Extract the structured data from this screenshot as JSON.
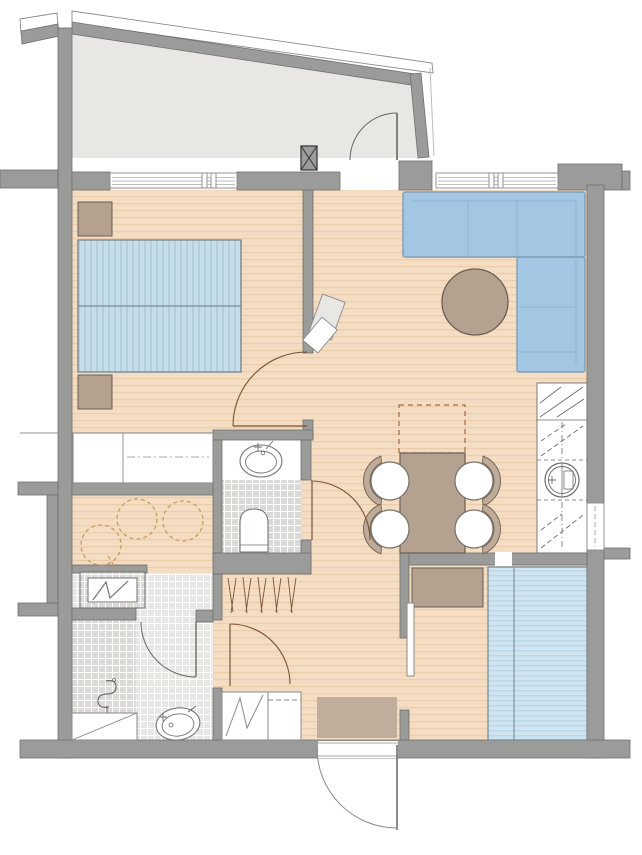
{
  "meta": {
    "kind": "architectural-floor-plan",
    "width_px": 642,
    "height_px": 855,
    "visible_text": []
  },
  "colors": {
    "wall": "#9b9b99",
    "wallEdge": "#6f6f6d",
    "dark": "#3a3a38",
    "floor": "#f4ddc2",
    "floorLine": "#eaceab",
    "terraceFloor": "#e9e7e4",
    "white": "#ffffff",
    "frameGray": "#8a8a88",
    "windowLine": "#a9a9a7",
    "bedFill": "#c7dee9",
    "bedStripe": "#b2cfe0",
    "beddingEdge": "#7b8a94",
    "sofaFill": "#a3c6e2",
    "sofaSeam": "#8fb2cf",
    "sofaEdge": "#7f9eb8",
    "bed2Fill": "#d0e5f0",
    "bed2Stripe": "#bad7e7",
    "tan": "#b4a190",
    "tanEdge": "#6b5f54",
    "chairFill": "#ffffff",
    "chairBack": "#bfab97",
    "tileLight": "#e9e7e4",
    "tileDark": "#dcdad7",
    "tileLine": "#ffffff",
    "fixtureEdge": "#78736e",
    "doorBrown": "#7d5233",
    "doorGray": "#666664",
    "dashTan": "#a5693f",
    "saunaDash": "#c79d62",
    "hatch": "#7a5336",
    "symbol": "#6b6b69",
    "doormat": "#c0ad9c",
    "lightLine": "#bbbbb9"
  },
  "plan": {
    "rooms": [
      {
        "name": "terrace",
        "floor": "light-gray",
        "features": [
          "sloped-parapet",
          "railing",
          "terrace-door"
        ]
      },
      {
        "name": "bedroom",
        "floor": "wood",
        "features": [
          "double-bed",
          "nightstand-top",
          "nightstand-bottom",
          "window",
          "wardrobe"
        ]
      },
      {
        "name": "living-room",
        "floor": "wood",
        "features": [
          "corner-sofa",
          "coffee-table",
          "window",
          "dashed-rug"
        ]
      },
      {
        "name": "dining-area",
        "floor": "wood",
        "features": [
          "dining-table",
          "four-chairs"
        ]
      },
      {
        "name": "wc",
        "floor": "tile",
        "features": [
          "washbasin",
          "toilet"
        ]
      },
      {
        "name": "sauna",
        "floor": "wood",
        "features": [
          "dashed-benches",
          "heater"
        ]
      },
      {
        "name": "bathroom",
        "floor": "tile",
        "features": [
          "floor-drain",
          "washbasin",
          "shower-screen"
        ]
      },
      {
        "name": "hallway",
        "floor": "wood",
        "features": [
          "coat-closet-hatched",
          "washing-machine",
          "appliance",
          "doormat"
        ]
      },
      {
        "name": "second-bedroom",
        "floor": "wood",
        "features": [
          "double-bed-2",
          "dresser",
          "sliding-panel"
        ]
      },
      {
        "name": "utility-column",
        "floor": "white",
        "features": [
          "boiler-circle",
          "shelf-symbols"
        ]
      }
    ],
    "doors": [
      "terrace-door",
      "bedroom-door",
      "wc-door",
      "bathroom-door",
      "second-bedroom-door",
      "entrance-door"
    ],
    "windows": [
      "bedroom-window",
      "living-room-window",
      "side-window"
    ],
    "structure": [
      "exterior-walls",
      "interior-walls",
      "x-column",
      "left-niche"
    ]
  }
}
